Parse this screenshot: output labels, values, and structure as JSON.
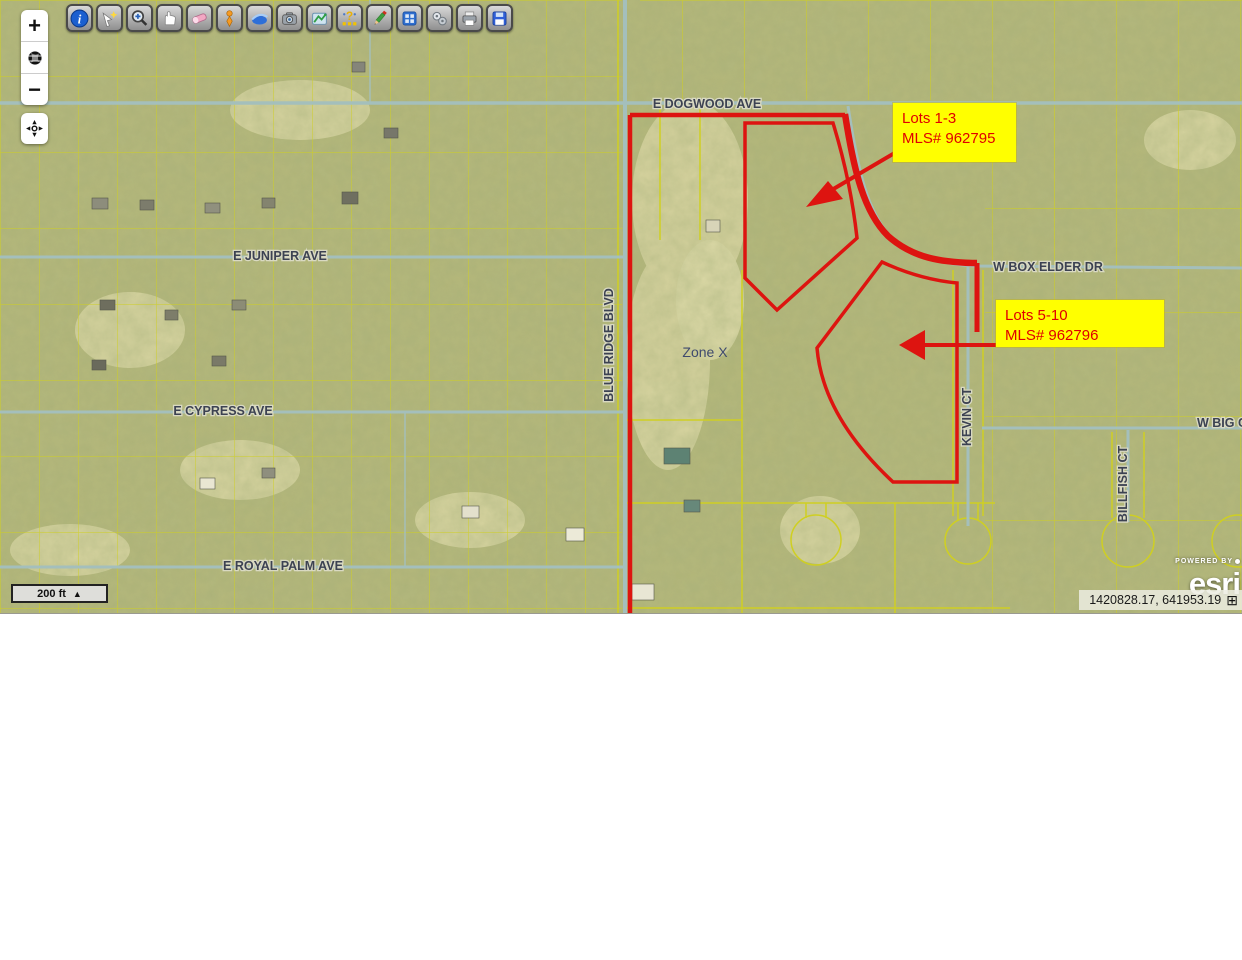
{
  "map": {
    "zone_label": "Zone X",
    "streets": {
      "dogwood": "E DOGWOOD AVE",
      "juniper": "E JUNIPER AVE",
      "cypress": "E CYPRESS AVE",
      "royal_palm": "E ROYAL PALM AVE",
      "blue_ridge": "BLUE RIDGE BLVD",
      "box_elder": "W BOX ELDER DR",
      "kevin": "KEVIN CT",
      "billfish": "BILLFISH CT",
      "big_partial": "W BIG C"
    },
    "callouts": [
      {
        "line1": "Lots 1-3",
        "line2": "MLS# 962795"
      },
      {
        "line1": "Lots 5-10",
        "line2": "MLS# 962796"
      }
    ],
    "colors": {
      "highlight_red": "#dd1410",
      "callout_bg": "#ffff00",
      "callout_text": "#e00000",
      "parcel_yellow": "#d2d21f",
      "road_teal": "#a4bfbc",
      "label_slate": "#3c4252"
    }
  },
  "toolbar": {
    "icons": [
      "info-icon",
      "select-flash-icon",
      "zoom-in-tool-icon",
      "pan-hand-icon",
      "eraser-icon",
      "marker-pin-icon",
      "swoosh-layer-icon",
      "camera-icon",
      "measure-map-icon",
      "address-question-icon",
      "draw-pencil-icon",
      "extent-grid-icon",
      "gears-icon",
      "print-icon",
      "save-icon"
    ]
  },
  "zoom_controls": {
    "zoom_in": "+",
    "zoom_out": "−"
  },
  "scalebar": {
    "label": "200 ft"
  },
  "attribution": {
    "powered_by": "POWERED BY",
    "brand": "esri"
  },
  "statusbar": {
    "coordinates": "1420828.17, 641953.19"
  }
}
